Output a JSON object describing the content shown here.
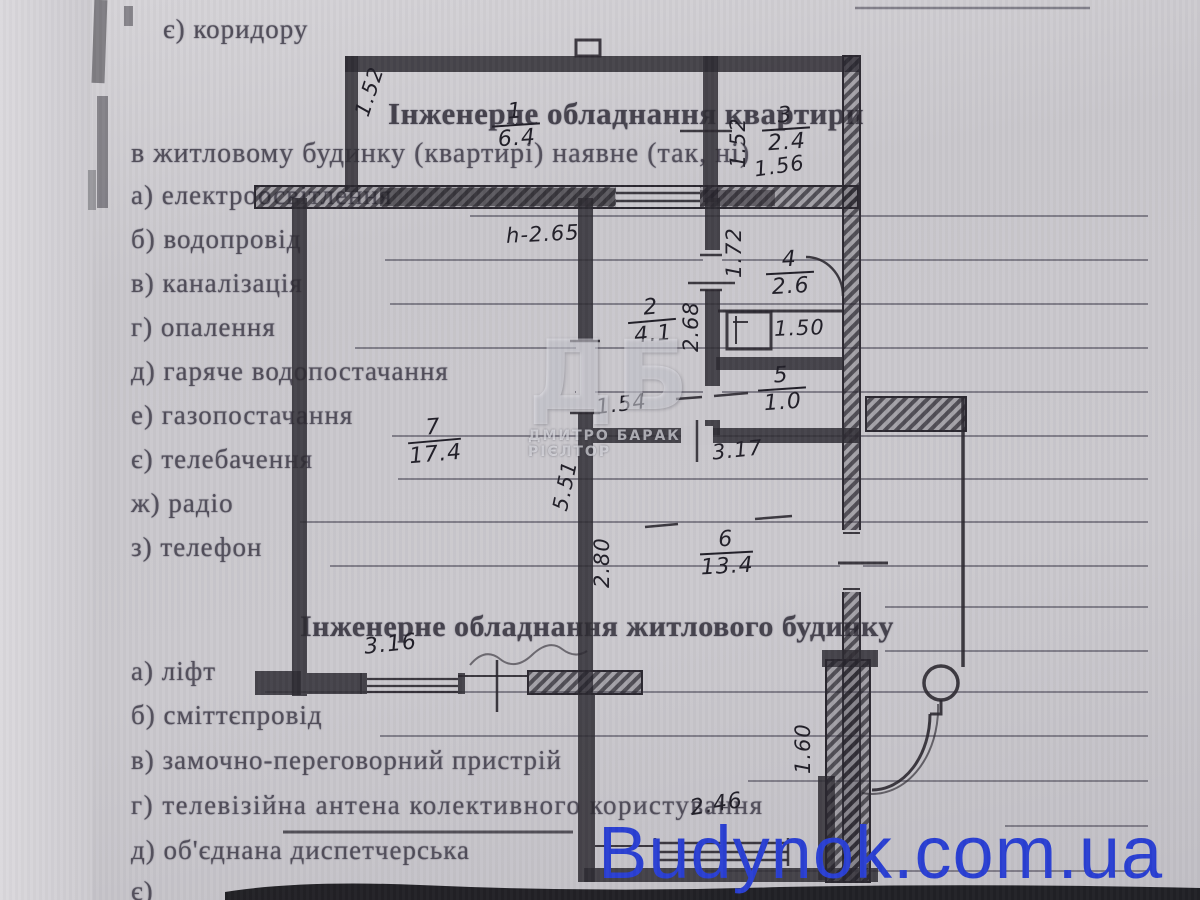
{
  "document": {
    "top_item": "є)  коридору",
    "section1": {
      "heading": "Інженерне обладнання квартири",
      "subheading": "в житловому будинку (квартирі) наявне (так, ні)",
      "items": [
        "а)  електроосвітлення",
        "б)  водопровід",
        "в)  каналізація",
        "г)  опалення",
        "д)  гаряче  водопостачання",
        "е)  газопостачання",
        "є)  телебачення",
        "ж) радіо",
        "з)  телефон"
      ]
    },
    "section2": {
      "heading": "Інженерне обладнання житлового будинку",
      "items": [
        "а)  ліфт",
        "б)  сміттєпровід",
        "в)  замочно-переговорний  пристрій",
        "г)  телевізійна антена колективного користування",
        "д)  об'єднана  диспетчерська",
        "є)"
      ]
    }
  },
  "floor_plan": {
    "rooms": {
      "r1": {
        "number": "1",
        "area": "6.4"
      },
      "r2": {
        "number": "2",
        "area": "4.1"
      },
      "r3": {
        "number": "3",
        "area": "2.4"
      },
      "r4": {
        "number": "4",
        "area": "2.6"
      },
      "r5": {
        "number": "5",
        "area": "1.0"
      },
      "r6": {
        "number": "6",
        "area": "13.4"
      },
      "r7": {
        "number": "7",
        "area": "17.4"
      }
    },
    "dims": {
      "d152a": "1.52",
      "d152b": "1.52",
      "d156": "1.56",
      "d172": "1.72",
      "d268": "2.68",
      "d154": "1.54",
      "h265": "h-2.65",
      "d150": "1.50",
      "d317": "3.17",
      "d551": "5.51",
      "d280": "2.80",
      "d316": "3.16",
      "d160": "1.60",
      "d246": "2.46"
    }
  },
  "watermarks": {
    "site": "Budynok.com.ua",
    "agency_monogram": "ДБ",
    "agency_caption": "ДМИТРО БАРАК РІЄЛТОР"
  }
}
